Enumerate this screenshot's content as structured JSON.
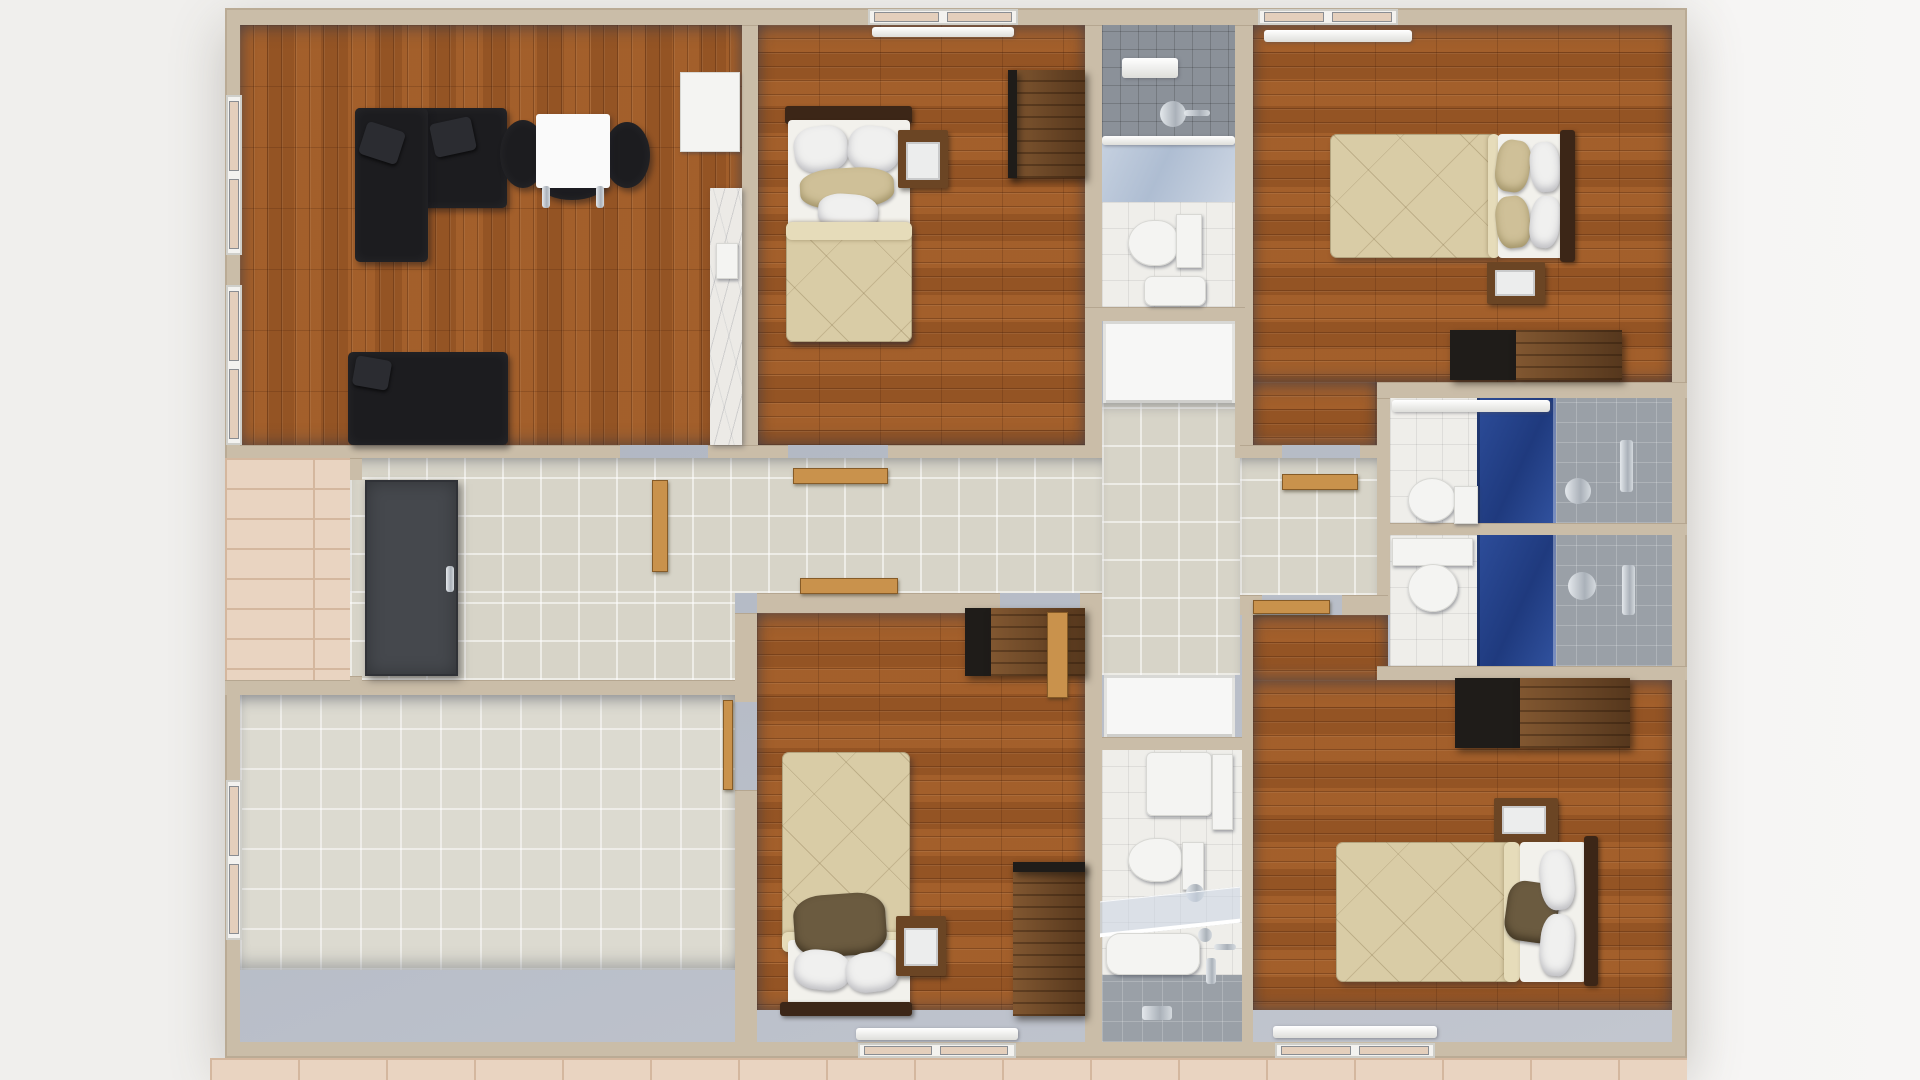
{
  "scene": {
    "kind": "3d-floor-plan-render",
    "view": "top-down-dollhouse",
    "visible_text": "none"
  },
  "colors": {
    "wall-top": "#cabda8",
    "wall-face": "#aab0bc",
    "wall-face-light": "#c2c6cf",
    "wood": "#9c5a28",
    "tile-hall": "#d7d4c8",
    "tile-room": "#dcdad0",
    "tile-white": "#efeeea",
    "tile-gray": "#9aa0a7",
    "tile-gray-dark": "#8b9199",
    "glass-blue": "#2d4d9a",
    "glass-blue-dark": "#1f3a7e",
    "bedding": "#d9cca6",
    "bedding-light": "#e6dcba",
    "pillow-white": "#f0f0ef",
    "pillow-brown": "#6b5b40",
    "head-dark": "#3c2617",
    "wood-furn": "#6b4524",
    "furn-black": "#1c1c1f",
    "door-front": "#45484d",
    "door-wood": "#c9924c",
    "white-fix": "#f4f4f2",
    "brick": "#e9d4c1",
    "brick-line": "#d4b79e",
    "pane": "#e4cfbc",
    "background": "#f0efed"
  },
  "rooms": [
    {
      "id": "living-room",
      "floor": "wood-parquet",
      "furniture": [
        "black-l-sofa",
        "two-black-cushions",
        "round-dining-table-white-top",
        "two-black-chairs",
        "black-loveseat",
        "white-tall-cabinet",
        "kitchen-counter-marble-with-sink"
      ],
      "windows": [
        "left-wall-upper",
        "left-wall-lower"
      ]
    },
    {
      "id": "bedroom-top-middle",
      "floor": "wood-parquet",
      "furniture": [
        "single-bed-beige",
        "white-pillows",
        "beige-pillow",
        "nightstand-dark-wood",
        "wardrobe-dark-wood"
      ],
      "windows": [
        "top-wall"
      ],
      "door": "open-to-hallway"
    },
    {
      "id": "bathroom-top-middle",
      "floor": "white-tile",
      "fixtures": [
        "shower-gray-tile-zone",
        "ceiling-vent",
        "shower-head-chrome",
        "glass-screen",
        "wall-hung-toilet",
        "small-sink"
      ],
      "door": "white-sliding-panel-south"
    },
    {
      "id": "bedroom-top-right",
      "floor": "wood-parquet",
      "furniture": [
        "double-bed-beige",
        "white-and-beige-pillows",
        "headboard-dark",
        "nightstand-dark-wood",
        "dresser-black-and-wood"
      ],
      "windows": [
        "top-wall-with-roller-pelmet"
      ],
      "door": "open-to-landing"
    },
    {
      "id": "bathroom-right-upper",
      "floor": "white-tile",
      "fixtures": [
        "toilet-with-cistern",
        "blue-glass-shower-panel",
        "gray-tile-shower-wall",
        "chrome-mixer",
        "chrome-handle",
        "white-sliding-door-top"
      ]
    },
    {
      "id": "bathroom-right-lower",
      "floor": "white-tile",
      "fixtures": [
        "cistern-shelf",
        "toilet",
        "blue-glass-shower-panel",
        "gray-tile-shower-wall",
        "shower-head-chrome",
        "chrome-handle"
      ]
    },
    {
      "id": "hallway",
      "floor": "beige-tile",
      "features": [
        "front-entry-dark-double-door-open",
        "five-open-wood-door-leaves",
        "cross-shaped-corridor"
      ]
    },
    {
      "id": "storage-room-bottom-left",
      "floor": "light-tile",
      "furniture": [],
      "windows": [
        "left-wall"
      ],
      "door": "open-to-bedroom-side"
    },
    {
      "id": "bedroom-bottom-middle",
      "floor": "wood-parquet",
      "furniture": [
        "single-bed-beige-head-south",
        "brown-accent-pillow",
        "white-pillows",
        "nightstand-dark-wood",
        "wardrobe-dark-wood",
        "cabinet-top-right"
      ],
      "windows": [
        "bottom-wall"
      ],
      "door": "open-on-north-wall"
    },
    {
      "id": "bathroom-bottom-middle",
      "floor": "white-tile",
      "fixtures": [
        "vanity-sink",
        "tall-white-cabinet",
        "wall-hung-toilet",
        "paper-holder-chrome",
        "glass-screen",
        "shower-tray",
        "gray-tile-shower-floor",
        "floor-drain-chrome"
      ],
      "door": "white-sliding-panel-north"
    },
    {
      "id": "bedroom-bottom-right",
      "floor": "wood-parquet",
      "furniture": [
        "double-bed-beige-head-east",
        "brown-accent-pillow",
        "white-pillows",
        "headboard-dark",
        "nightstand-dark-wood",
        "dresser-black-and-wood"
      ],
      "windows": [
        "bottom-wall"
      ],
      "door": "open-to-hall-extension"
    }
  ],
  "outdoor": [
    {
      "id": "terrace-left",
      "surface": "tan-brick-tiles"
    },
    {
      "id": "terrace-bottom",
      "surface": "tan-brick-tiles"
    }
  ],
  "counts": {
    "bedrooms": 4,
    "bathrooms": 4,
    "beds_single": 2,
    "beds_double": 2,
    "windows": 8,
    "white_sliding_panels": 2
  }
}
